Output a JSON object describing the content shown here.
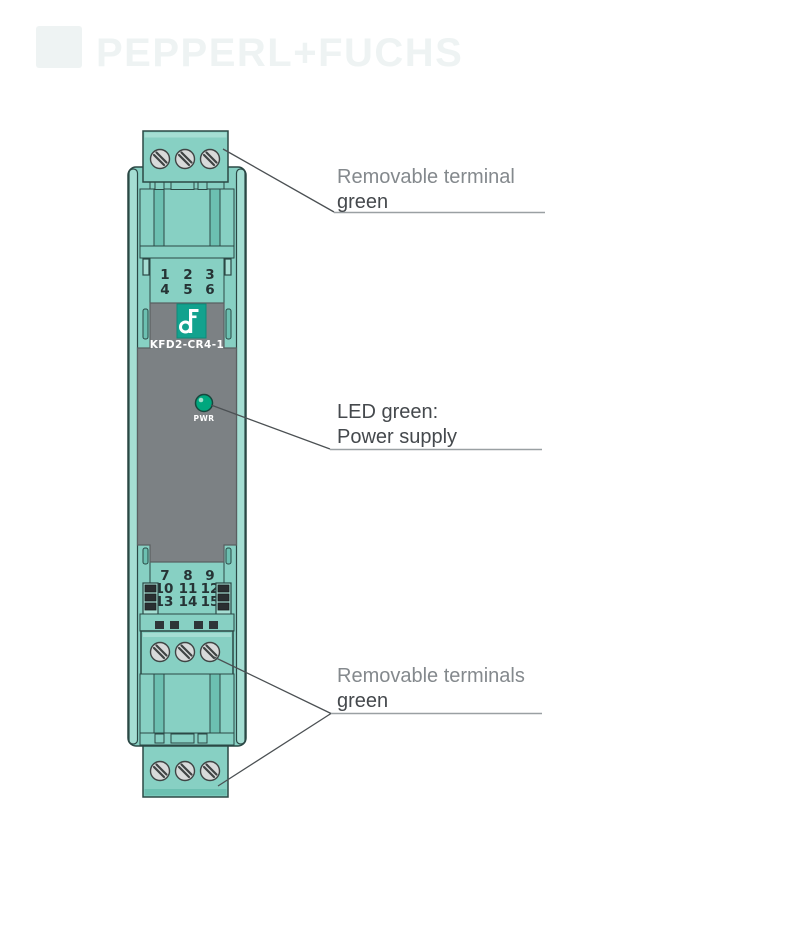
{
  "watermark": {
    "brand": "PEPPERL+FUCHS"
  },
  "device": {
    "model": "KFD2-CR4-1",
    "led_label": "PWR",
    "top_terminal_numbers": [
      [
        "1",
        "2",
        "3"
      ],
      [
        "4",
        "5",
        "6"
      ]
    ],
    "bottom_terminal_numbers": [
      [
        "7",
        "8",
        "9"
      ],
      [
        "10",
        "11",
        "12"
      ],
      [
        "13",
        "14",
        "15"
      ]
    ]
  },
  "callouts": {
    "top_terminal": {
      "line1": "Removable terminal",
      "line2": "green"
    },
    "led": {
      "line1": "LED green:",
      "line2": "Power supply"
    },
    "bottom_terminals": {
      "line1": "Removable terminals",
      "line2": "green"
    }
  },
  "colors": {
    "teal": "#87d0c3",
    "teal_light": "#a5ded3",
    "teal_dark": "#6cc0b1",
    "outline": "#2b4845",
    "gray_panel": "#7c8184",
    "gray_border": "#5a5f61",
    "led_green": "#00a77e",
    "logo_teal": "#12a28e",
    "screw_fill": "#d8dada",
    "screw_line": "#3f4444",
    "number_color": "#263335",
    "annotation_light": "#84898d",
    "annotation_dark": "#45494d",
    "leader": "#4b5053",
    "underline": "#9aa0a3",
    "watermark": "#eef3f3"
  }
}
